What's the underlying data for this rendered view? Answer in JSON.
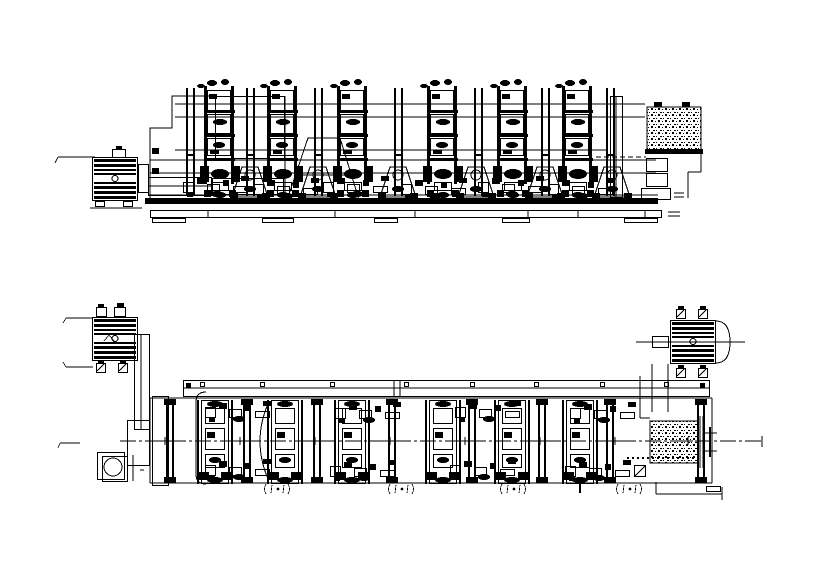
{
  "document": {
    "type": "technical-cad-drawing",
    "description": "Black and white engineering CAD drawing of a multi-unit printing machine line: side elevation view on top, plan view below",
    "background_color": "#ffffff",
    "line_color": "#000000"
  },
  "elevation_view": {
    "name": "elevation-view",
    "print_unit_count": 6,
    "components": [
      "drive-motor",
      "motor-feet",
      "drive-shaft-housing",
      "gear-housing",
      "support-pedestal",
      "print-tower",
      "frame-post",
      "cylinder-saddle",
      "base-rail",
      "foundation-platform",
      "foundation-feet",
      "platform-grating",
      "access-ladder",
      "handrail-leg"
    ]
  },
  "plan_view": {
    "name": "plan-view",
    "print_unit_count": 6,
    "components": [
      "drive-motor-left",
      "drive-motor-right",
      "motor-terminal-box",
      "motor-foot-pad",
      "motor-end-bell",
      "drive-column",
      "pump-circle-unit",
      "guard-rail-band",
      "unit-stack",
      "cross-rail-pair",
      "platform-grating",
      "machine-centerline",
      "centerline-plus-mark",
      "section-mark",
      "anchor-cross-mark"
    ]
  }
}
